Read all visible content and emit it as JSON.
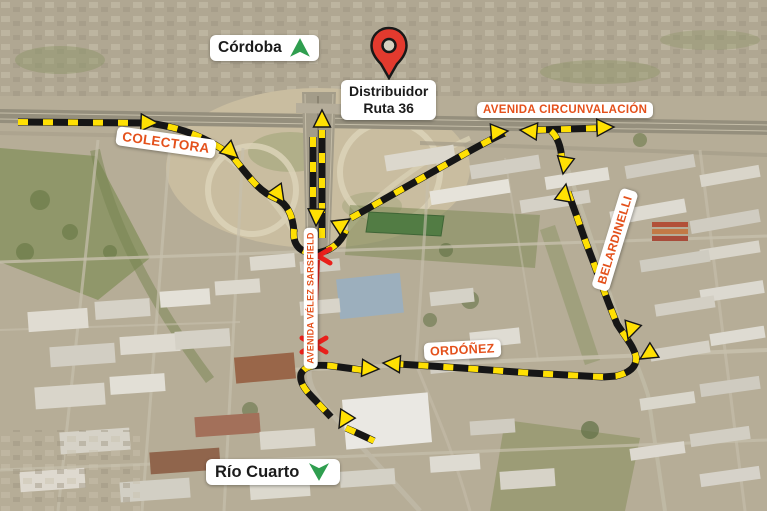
{
  "labels": {
    "destination_north": "Córdoba",
    "pin_caption_line1": "Distribuidor",
    "pin_caption_line2": "Ruta 36",
    "avenue_circunvalacion": "AVENIDA CIRCUNVALACIÓN",
    "colectora": "COLECTORA",
    "belardinelli": "BELARDINELLI",
    "ordonez": "ORDÓÑEZ",
    "velez_sarsfield": "AVENIDA VÉLEZ SARSFIELD",
    "destination_south": "Río Cuarto"
  },
  "colors": {
    "route_black": "#161616",
    "route_yellow": "#FFE003",
    "closure_red": "#E9201B",
    "street_label_orange": "#E4511C",
    "direction_green": "#2F9E4F",
    "pin_red": "#E33A2E",
    "pin_outline": "#191919",
    "label_bg": "#FFFFFF",
    "label_text": "#1B1B1B"
  }
}
